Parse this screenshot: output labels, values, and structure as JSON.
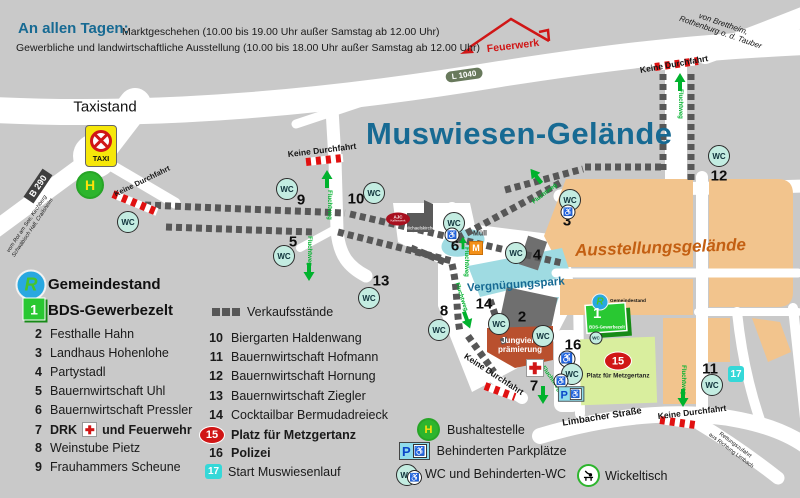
{
  "header": {
    "intro": "An allen Tagen:",
    "line1": "Marktgeschehen (10.00 bis 19.00 Uhr außer Samstag ab 12.00 Uhr)",
    "line2": "Gewerbliche und landwirtschaftliche Ausstellung (10.00 bis 18.00 Uhr außer Samstag ab 12.00 Uhr)"
  },
  "map": {
    "title": "Muswiesen-Gelände",
    "areas": {
      "exhibition": "Ausstellungsgelände",
      "funpark": "Vergnügungspark",
      "jungvieh1": "Jungvieh-",
      "jungvieh2": "prämierung",
      "metzgertanz": "Platz für Metzgertanz"
    },
    "roads": {
      "l1040": "L 1040",
      "b290": "B 290",
      "limbacher": "Limbacher Straße",
      "rettung1": "Rettungszufahrt",
      "rettung2": "aus Richtung Limbach",
      "brettheim1": "von Brettheim,",
      "brettheim2": "Rothenburg o. d. Tauber",
      "rotamsee1": "vom Rot am See, Kirchberg",
      "rotamsee2": "Schwäbisch Hall, Crailsheim"
    },
    "labels": {
      "taxistand": "Taxistand",
      "taxi": "TAXI",
      "feuerwerk": "Feuerwerk",
      "keine_durchfahrt": "Keine Durchfahrt",
      "fluchtweg": "Fluchtweg",
      "wc": "WC",
      "wheelchair": "♿",
      "muell": "Müll",
      "m": "M",
      "h": "H",
      "p": "P",
      "michaelskirche": "Michaelskirche",
      "kaffee1": "AJC",
      "kaffee2": "Kaffeewerk",
      "gemeindestand": "Gemeindestand",
      "bds": "BDS-Gewerbezelt"
    }
  },
  "legend": {
    "gemeindestand": "Gemeindestand",
    "bds_num": "1",
    "bds": "BDS-Gewerbezelt",
    "verkaufsstaende": "Verkaufsstände",
    "left": [
      {
        "num": "2",
        "name": "Festhalle Hahn"
      },
      {
        "num": "3",
        "name": "Landhaus Hohenlohe"
      },
      {
        "num": "4",
        "name": "Partystadl"
      },
      {
        "num": "5",
        "name": "Bauernwirtschaft Uhl"
      },
      {
        "num": "6",
        "name": "Bauernwirtschaft Pressler"
      },
      {
        "num": "7",
        "pre": "DRK",
        "post": "und Feuerwehr"
      },
      {
        "num": "8",
        "name": "Weinstube Pietz"
      },
      {
        "num": "9",
        "name": "Frauhammers Scheune"
      }
    ],
    "right": [
      {
        "num": "10",
        "name": "Biergarten Haldenwang"
      },
      {
        "num": "11",
        "name": "Bauernwirtschaft Hofmann"
      },
      {
        "num": "12",
        "name": "Bauernwirtschaft Hornung"
      },
      {
        "num": "13",
        "name": "Bauernwirtschaft Ziegler"
      },
      {
        "num": "14",
        "name": "Cocktailbar Bermudadreieck"
      },
      {
        "num": "15",
        "name": "Platz für Metzgertanz"
      },
      {
        "num": "16",
        "name": "Polizei"
      },
      {
        "num": "17",
        "name": "Start Muswiesenlauf"
      }
    ],
    "bottom": {
      "bus": "Bushaltestelle",
      "parking": "Behinderten Parkplätze",
      "wc": "WC und Behinderten-WC",
      "wickeltisch": "Wickeltisch"
    }
  },
  "colors": {
    "background": "#c9c9c9",
    "road": "#ffffff",
    "title_blue": "#176a93",
    "exhibition_orange": "#f2c48d",
    "exhibition_text": "#c35f12",
    "funpark_cyan": "#9fdbe2",
    "stall_gray": "#575757",
    "wc_fill": "#c3ece1",
    "alert_red": "#d01616",
    "flucht_green": "#00b22d",
    "metzgertanz_green": "#d9ee9e",
    "bds_green": "#29c832",
    "jungvieh_rust": "#b9502e"
  }
}
